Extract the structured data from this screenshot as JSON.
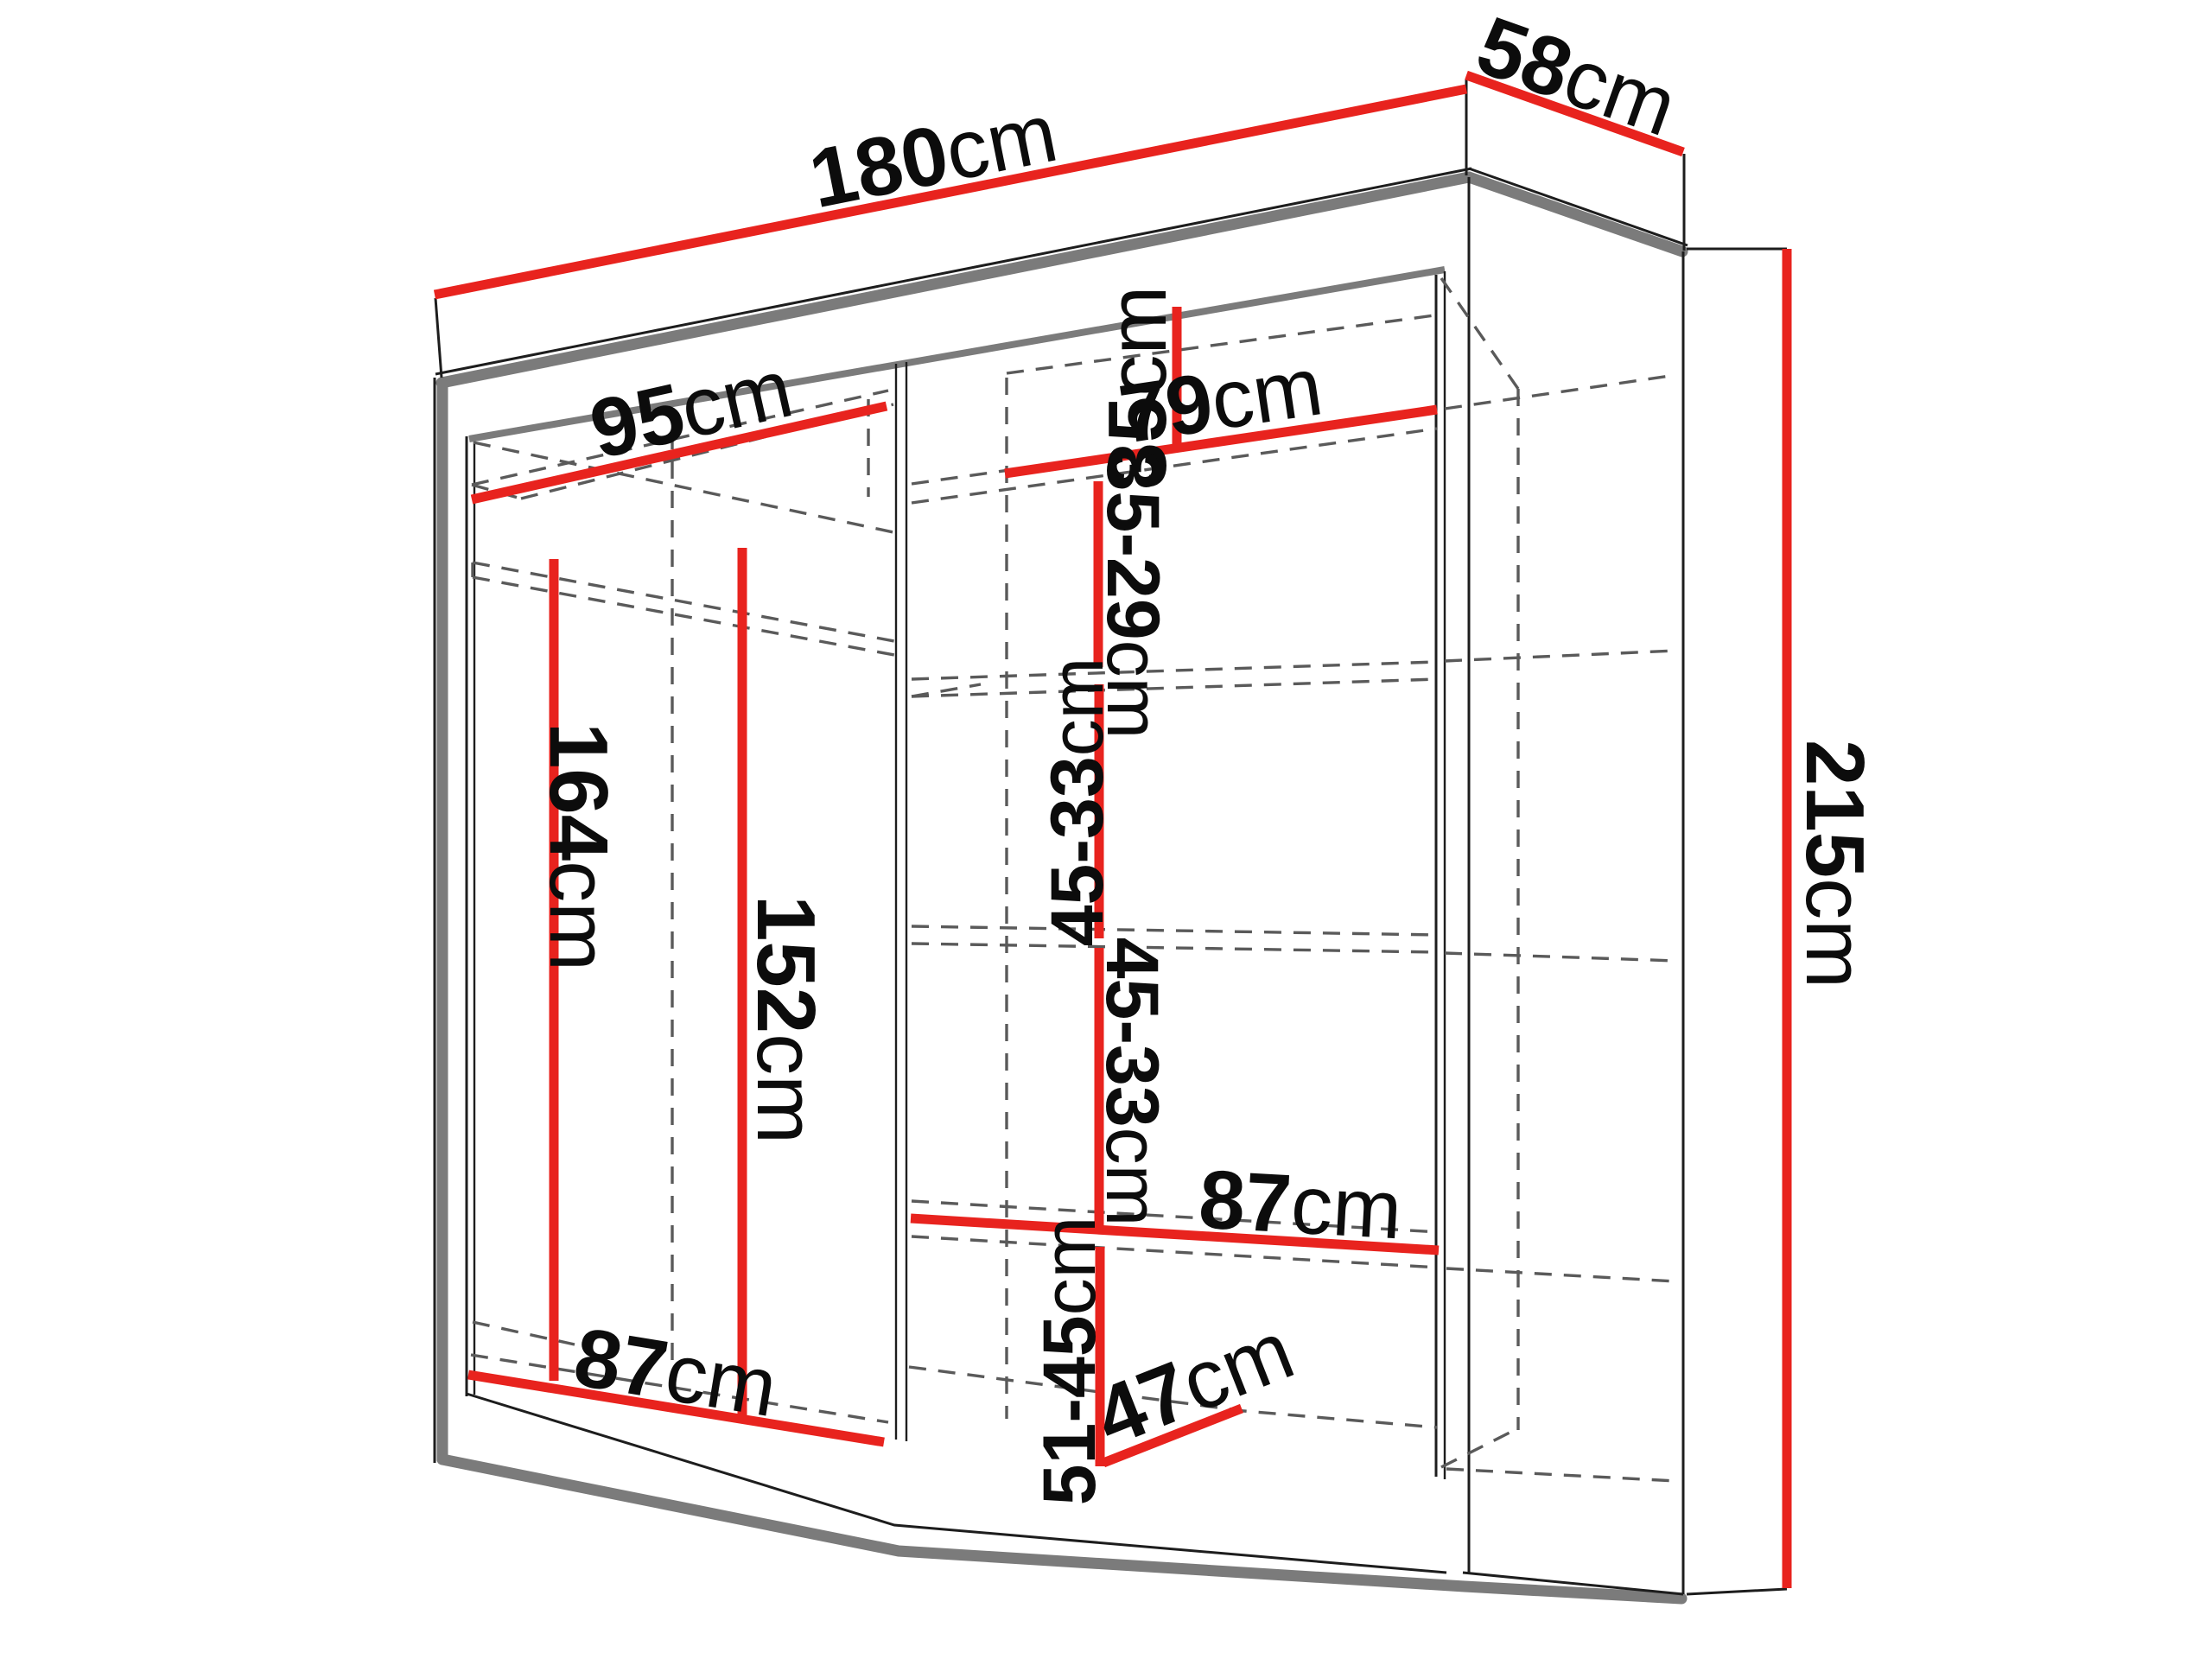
{
  "diagram": {
    "type": "wardrobe-dimension-diagram",
    "colors": {
      "dimension_line": "#e8231e",
      "structure_edge": "#7b7b7b",
      "hidden_edge": "#5a5a5a",
      "outline": "#1d1d1d",
      "label_text": "#0c0c0c",
      "background": "#ffffff"
    },
    "dimensions": {
      "total_width": {
        "value": "180",
        "unit": "cm"
      },
      "total_depth": {
        "value": "58",
        "unit": "cm"
      },
      "total_height": {
        "value": "215",
        "unit": "cm"
      },
      "left_shelf_width": {
        "value": "95",
        "unit": "cm"
      },
      "right_shelf_width_top": {
        "value": "79",
        "unit": "cm"
      },
      "top_shelf_drop": {
        "value": "35",
        "unit": "cm"
      },
      "shelf_gap_upper": {
        "value": "35-29",
        "unit": "cm"
      },
      "shelf_gap_mid_upper": {
        "value": "45-33",
        "unit": "cm"
      },
      "shelf_gap_mid_lower": {
        "value": "45-33",
        "unit": "cm"
      },
      "shelf_gap_bottom": {
        "value": "51-45",
        "unit": "cm"
      },
      "right_shelf_width_bottom": {
        "value": "87",
        "unit": "cm"
      },
      "left_bottom_width": {
        "value": "87",
        "unit": "cm"
      },
      "interior_depth": {
        "value": "47",
        "unit": "cm"
      },
      "hanging_height_left": {
        "value": "164",
        "unit": "cm"
      },
      "hanging_height_right": {
        "value": "152",
        "unit": "cm"
      }
    }
  }
}
